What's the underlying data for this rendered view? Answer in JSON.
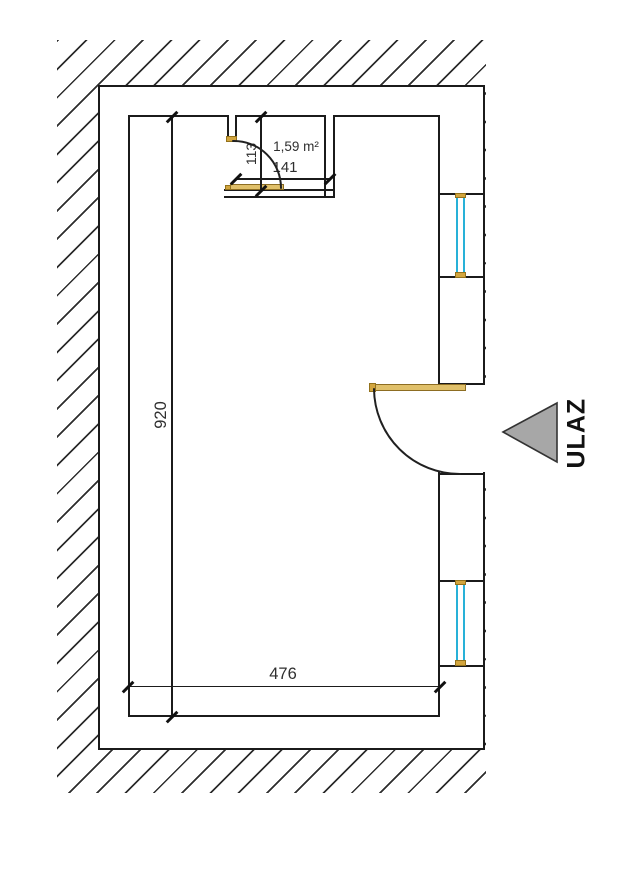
{
  "document": {
    "type": "floor-plan"
  },
  "labels": {
    "area": "1,59 m²",
    "entrance": "ULAZ"
  },
  "dimensions": {
    "room_length": "920",
    "room_width": "476",
    "closet_width": "141",
    "closet_depth": "113"
  },
  "colors": {
    "line": "#1b1b1b",
    "glazing": "#28b1d8",
    "frame_wood": "#d2a53e",
    "door_wood": "#e0c06a",
    "entrance_arrow": "#a7a7a7"
  }
}
